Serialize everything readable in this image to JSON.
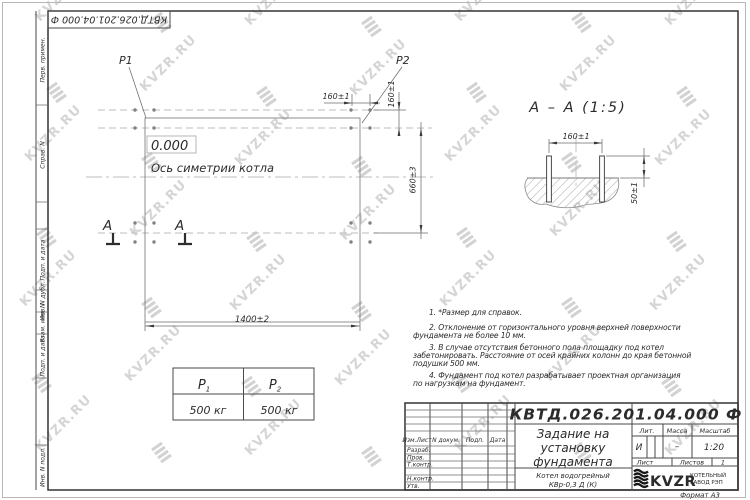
{
  "sheet": {
    "stamp_doc_number": "КВТД.026.201.04.000  Ф",
    "format_label": "Формат А3",
    "margins": {
      "perv": "Перв. примен.",
      "sprav": "Справ. N",
      "podp1": "Подп. и дата",
      "dubl": "Инв. N дубл.",
      "vzam": "Взам. инв. N",
      "podp2": "Подп. и дата",
      "podl": "Инв. N подл."
    }
  },
  "watermark": {
    "text": "KVZR.RU"
  },
  "plan": {
    "p1_label": "P1",
    "p2_label": "P2",
    "level": "0.000",
    "axis_label": "Ось симетрии котла",
    "section_letter": "А",
    "dims": {
      "width": "1400±2",
      "height": "660±3",
      "bolt_spacing": "160±1"
    }
  },
  "section": {
    "title": "А – А (1:5)",
    "dims": {
      "bolt_spacing": "160±1",
      "bolt_height": "50±1"
    }
  },
  "notes": {
    "lines": [
      "1. *Размер для справок.",
      "2. Отклонение от горизонтального уровня верхней поверхности",
      "фундамента не более 10 мм.",
      "3. В случае отсутствия бетонного пола площадку под котел",
      "забетонировать. Расстояние от осей крайних колонн до края бетонной",
      "подушки 500 мм.",
      "4. Фундамент под котел разрабатывает проектная организация",
      "по нагрузкам на фундамент."
    ]
  },
  "load_table": {
    "p1": {
      "sym": "P",
      "sub": "1",
      "value": "500 кг"
    },
    "p2": {
      "sym": "P",
      "sub": "2",
      "value": "500 кг"
    }
  },
  "title_block": {
    "doc_number": "КВТД.026.201.04.000  Ф",
    "title_l1": "Задание на",
    "title_l2": "установку",
    "title_l3": "фундамента",
    "product_l1": "Котел водогрейный",
    "product_l2": "КВр-0,3 Д (К)",
    "col_izm": "Изм.Лист",
    "col_doc": "N докум.",
    "col_sign": "Подп.",
    "col_date": "Дата",
    "row_razrab": "Разраб.",
    "row_prov": "Пров.",
    "row_tkontr": "Т.контр.",
    "row_nkontr": "Н.контр.",
    "row_utv": "Утв.",
    "lit_label": "Лит.",
    "mass_label": "Масса",
    "scale_label": "Масштаб",
    "lit_value": "И",
    "mass_value": "–",
    "scale_value": "1:20",
    "sheet_label": "Лист",
    "sheets_label": "Листов",
    "sheets_value": "1",
    "logo": "KVZR",
    "logo_line1": "КОТЕЛЬНЫЙ",
    "logo_line2": "ЗАВОД РЭП"
  }
}
